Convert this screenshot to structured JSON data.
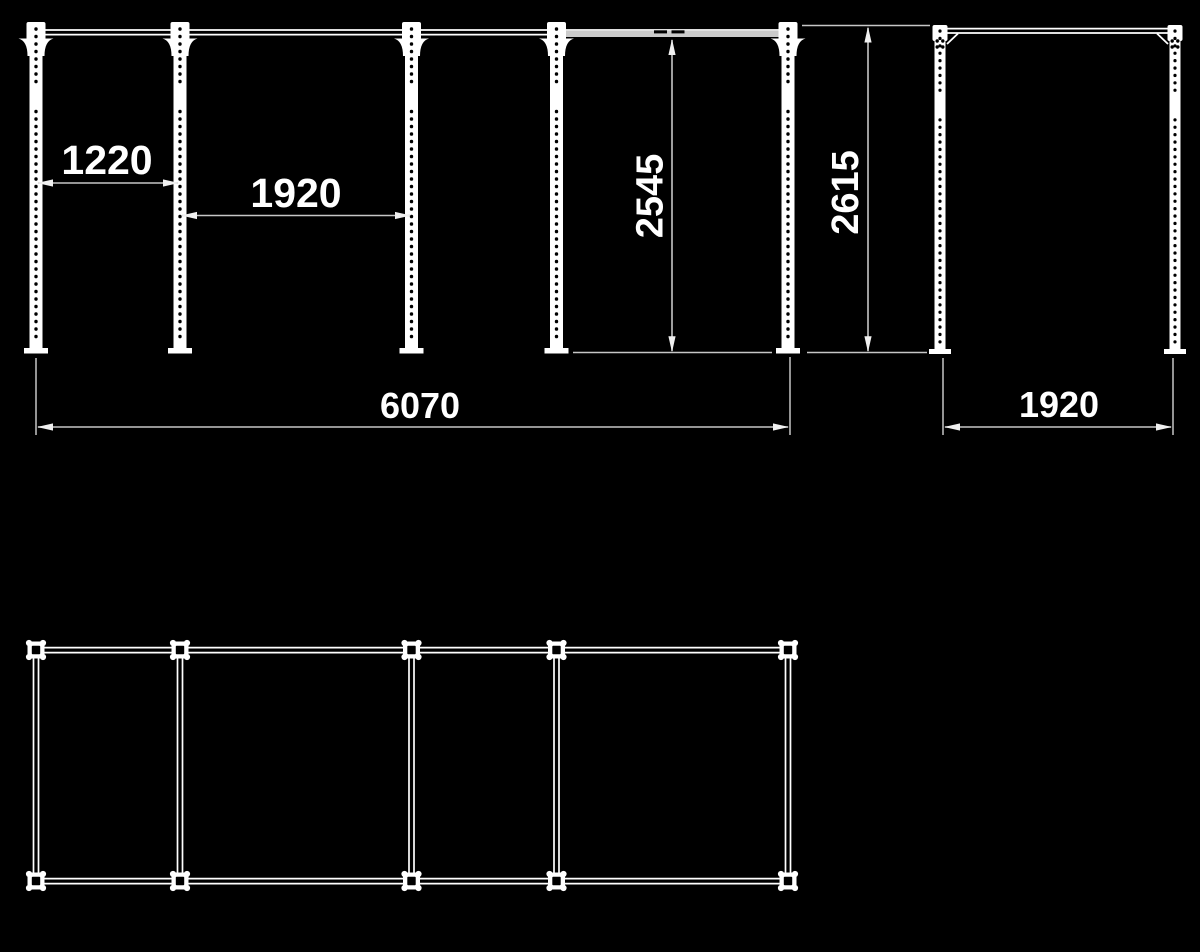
{
  "colors": {
    "background": "#000000",
    "structure": "#ffffff",
    "dimension_lines": "#c6c6c6",
    "pullup_bar": "#cbcbcb"
  },
  "front_view": {
    "post_count": 5,
    "bay_width_1": "1220",
    "bay_width_2": "1920",
    "bar_height": "2545",
    "overall_height": "2615",
    "overall_width": "6070"
  },
  "side_view": {
    "post_count": 2,
    "depth": "1920"
  },
  "plan_view": {
    "node_columns": 5,
    "node_rows": 2
  }
}
